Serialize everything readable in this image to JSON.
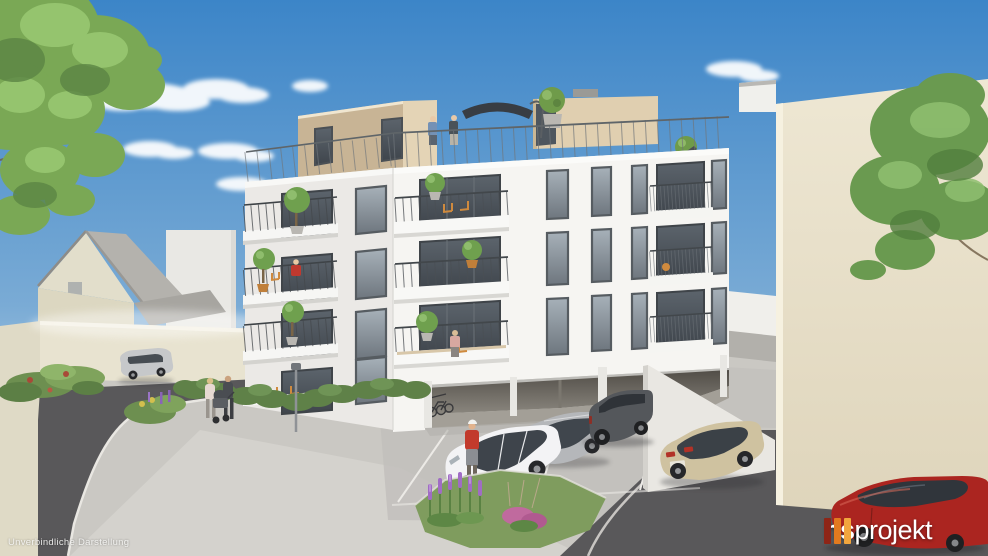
{
  "watermark": {
    "text": "Unverbindliche Darstellung",
    "color": "#f5f5f3"
  },
  "brand": {
    "name_bold": "hs",
    "name_light": "projekt",
    "text_color": "#ffffff",
    "bar_colors": [
      "#8e2517",
      "#e27a1f",
      "#f2a63e"
    ]
  },
  "scene": {
    "palette": {
      "sky_top": "#3c85c8",
      "sky_mid": "#7aabd5",
      "sky_horizon": "#dbeaf3",
      "facade_lit": "#f6f5f2",
      "facade_shaded": "#ebe9e6",
      "penthouse_front": "#e4d4b6",
      "penthouse_side": "#c8b495",
      "neighbor_beige": "#eee7d3",
      "asphalt": "#59585a",
      "pavement": "#cac8c3",
      "hedge": "#5f8148",
      "foliage": "#7aa855"
    },
    "cars": [
      {
        "name": "silver-hatchback",
        "color": "#c6c8ca"
      },
      {
        "name": "white-sedan",
        "color": "#f3f3f5"
      },
      {
        "name": "silver-estate",
        "color": "#b5b7ba"
      },
      {
        "name": "grey-suv",
        "color": "#54575b"
      },
      {
        "name": "beige-saloon",
        "color": "#cfc2a0"
      },
      {
        "name": "red-car",
        "color": "#ab2520"
      }
    ]
  }
}
